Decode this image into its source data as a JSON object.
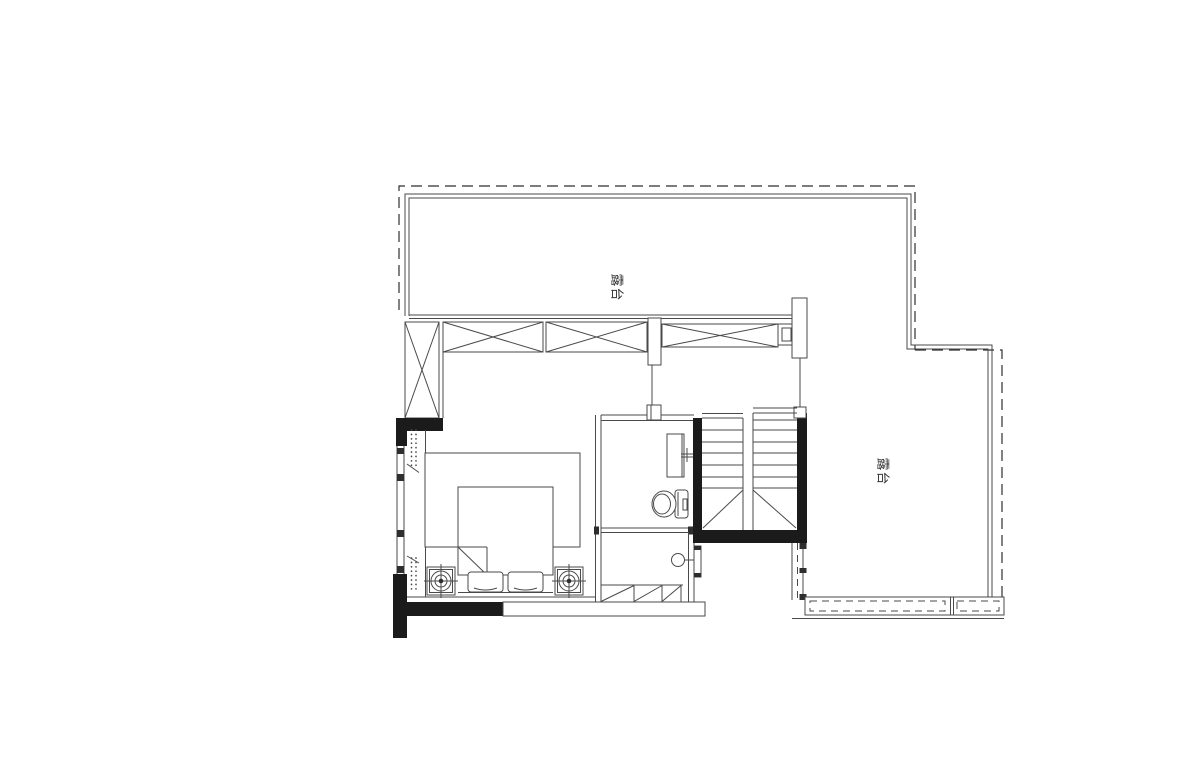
{
  "canvas": {
    "width": 1200,
    "height": 776,
    "background": "#ffffff"
  },
  "colors": {
    "line": "#4a4a4a",
    "line_dark": "#2e2e2e",
    "wall_fill": "#1b1b1b",
    "text": "#333333",
    "bg": "#ffffff"
  },
  "labels": {
    "terrace_top": "露台",
    "terrace_right": "露台"
  }
}
